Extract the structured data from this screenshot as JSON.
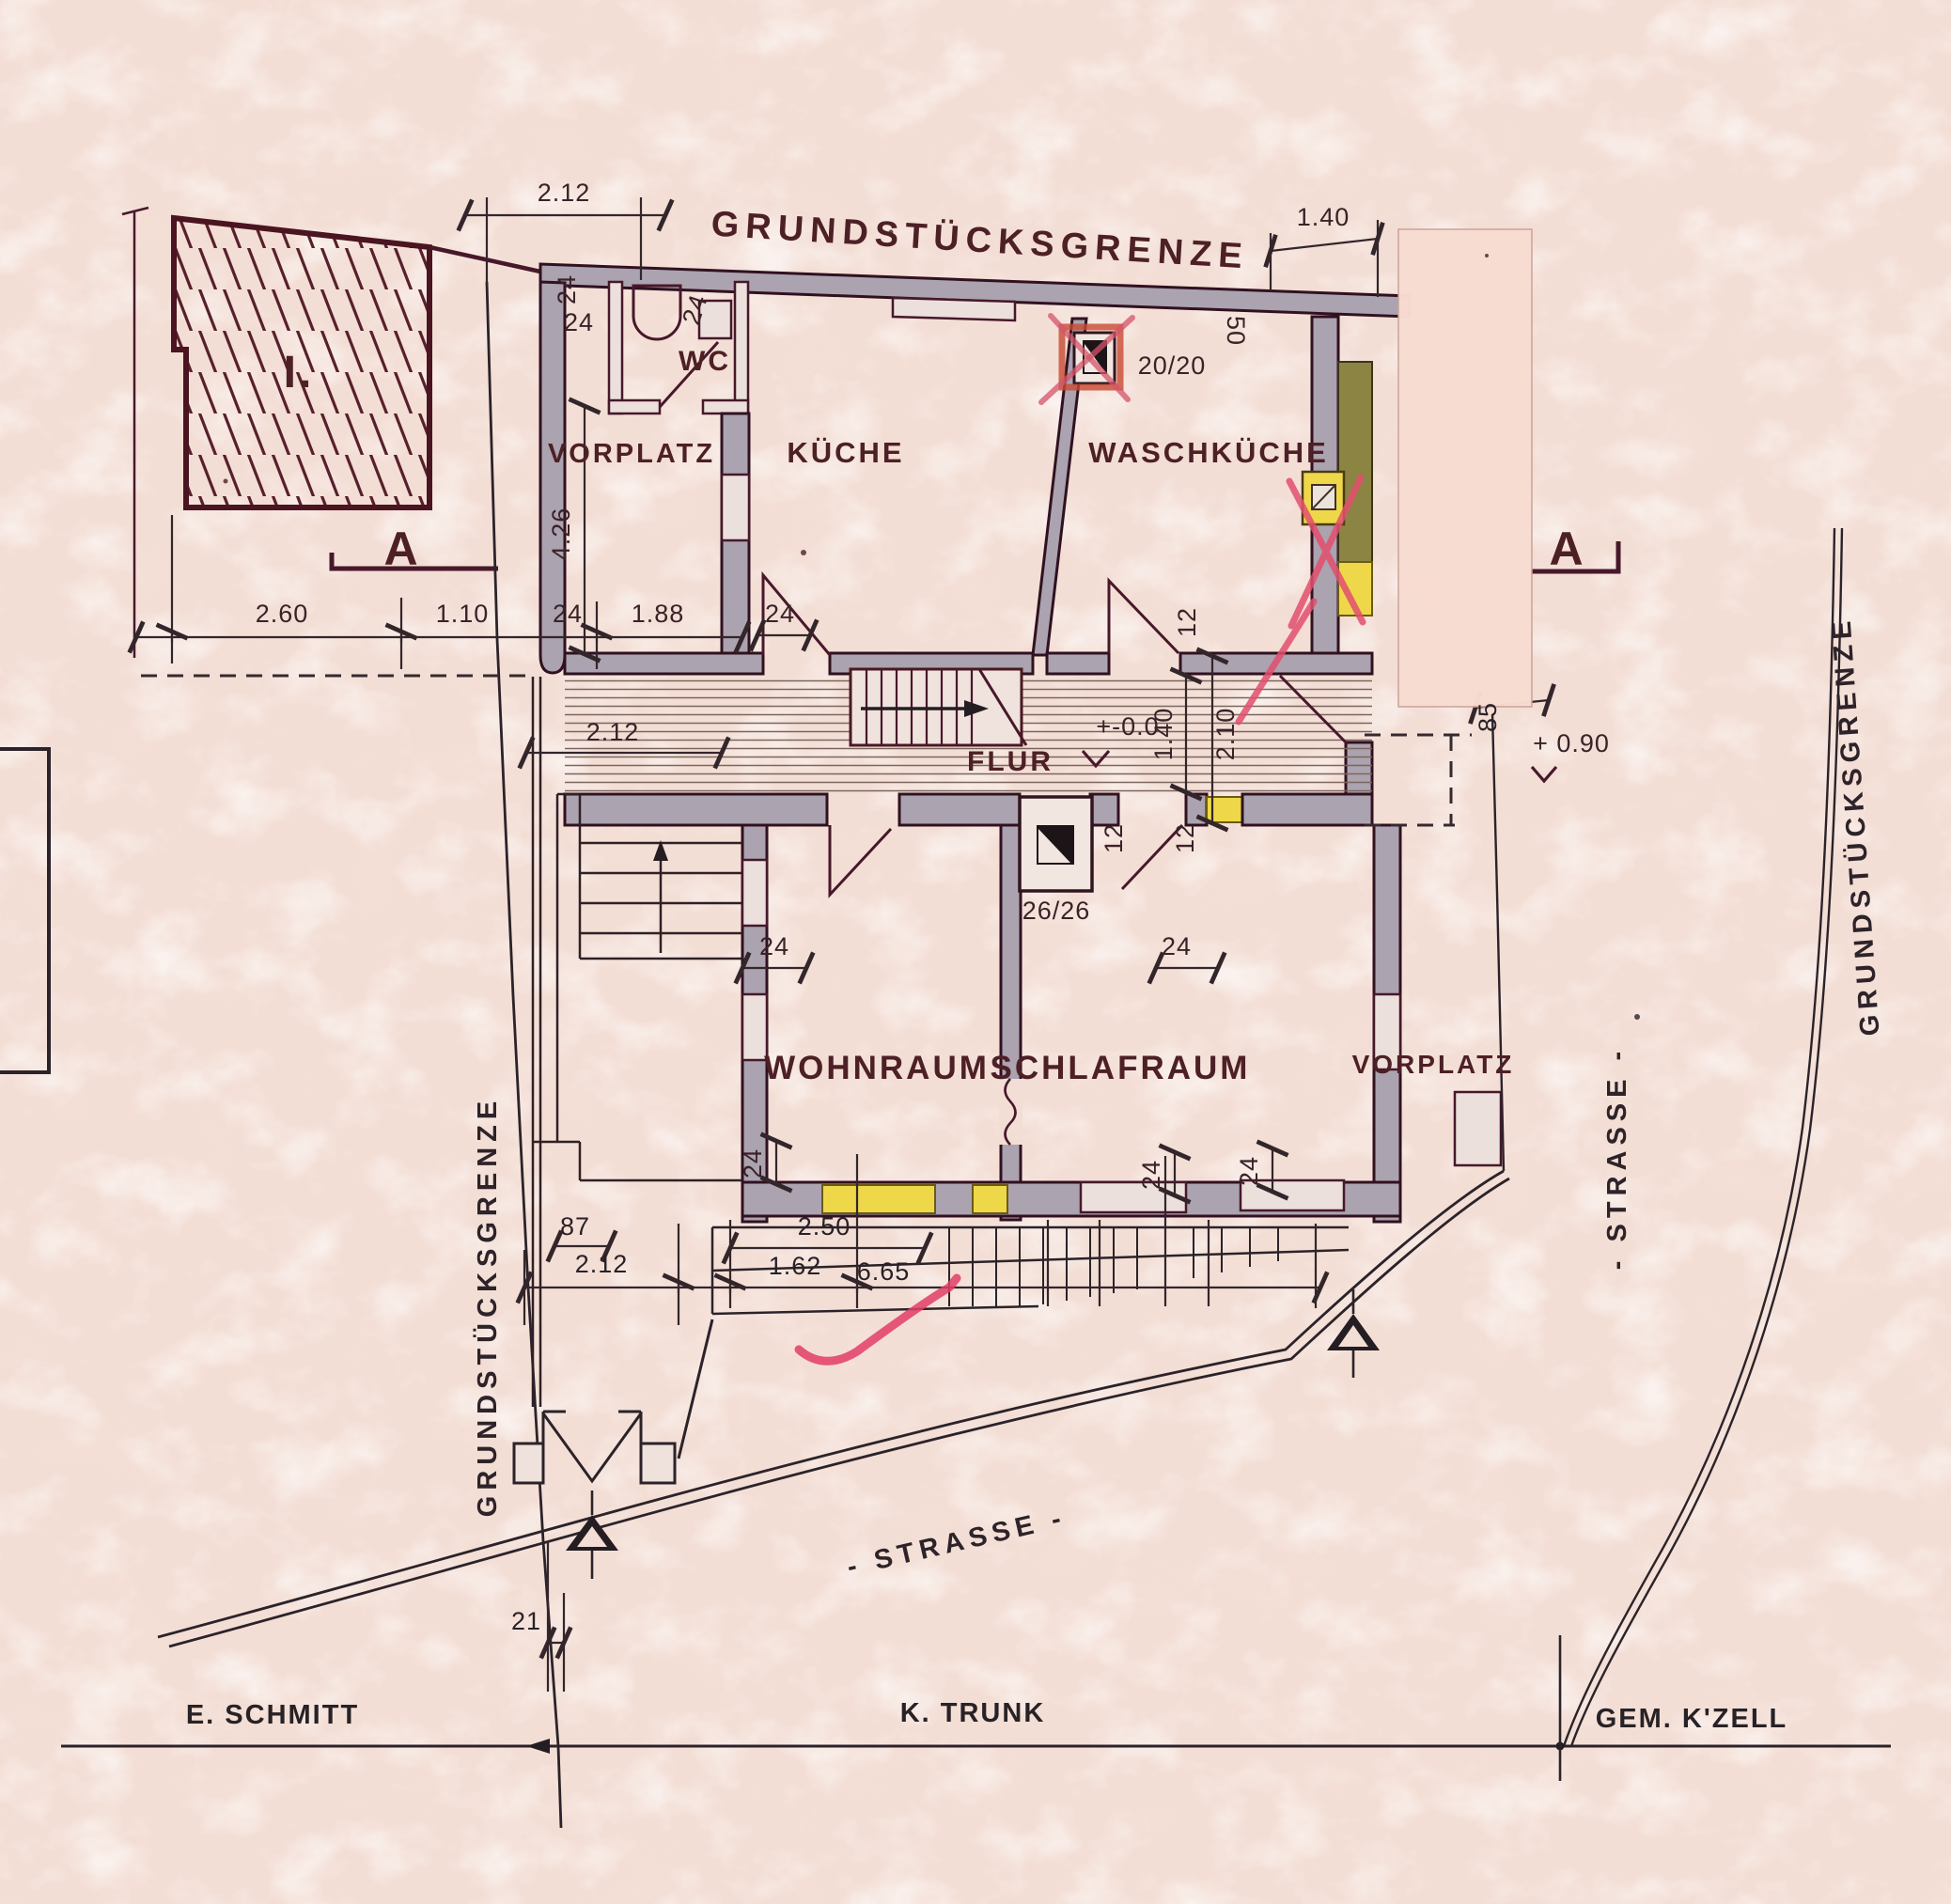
{
  "plan": {
    "boundaries": {
      "top": "GRUNDSTÜCKSGRENZE",
      "left": "GRUNDSTÜCKSGRENZE",
      "right": "GRUNDSTÜCKSGRENZE"
    },
    "streets": {
      "bottom": "- STRASSE -",
      "right": "- STRASSE -"
    },
    "sections": {
      "left": "A",
      "right": "A"
    },
    "neighbor_building": "I.",
    "rooms": {
      "vorplatz_top": "VORPLATZ",
      "wc": "WC",
      "kueche": "KÜCHE",
      "waschkueche": "WASCHKÜCHE",
      "flur": "FLUR",
      "wohnraum": "WOHNRAUM",
      "schlafraum": "SCHLAFRAUM",
      "vorplatz_right": "VORPLATZ"
    },
    "levels": {
      "flur": "+-0.0",
      "street": "+ 0.90"
    },
    "chimneys": {
      "kueche": "20/20",
      "flur": "26/26"
    },
    "owners": {
      "left": "E. SCHMITT",
      "center": "K. TRUNK",
      "right": "GEM. K'ZELL"
    },
    "dims": {
      "top_width": "2.12",
      "top_right": "1.40",
      "wall_top": "50",
      "row_left": [
        "2.60",
        "1.10",
        "24",
        "1.88"
      ],
      "v_height": "4.26",
      "wc": [
        "24",
        "24",
        "24"
      ],
      "door_k": "24",
      "mid_width": "2.12",
      "jamb": [
        "12",
        "12",
        "12"
      ],
      "flur_w": [
        "1.40",
        "2.10"
      ],
      "right_offset": "85",
      "low_width": "2.12",
      "bottom": [
        "87",
        "2.50",
        "1.62",
        "6.65"
      ],
      "walls24": [
        "24",
        "24",
        "24",
        "24",
        "24"
      ],
      "gate": "21"
    },
    "colors": {
      "ink": "#4a1824",
      "black": "#2b2329",
      "wall": "#aba3af",
      "yellow": "#eed84a",
      "olive": "#8b8443",
      "patch": "#f8dcd2",
      "red": "#d94f6a",
      "paper": "#f3ded5"
    }
  }
}
